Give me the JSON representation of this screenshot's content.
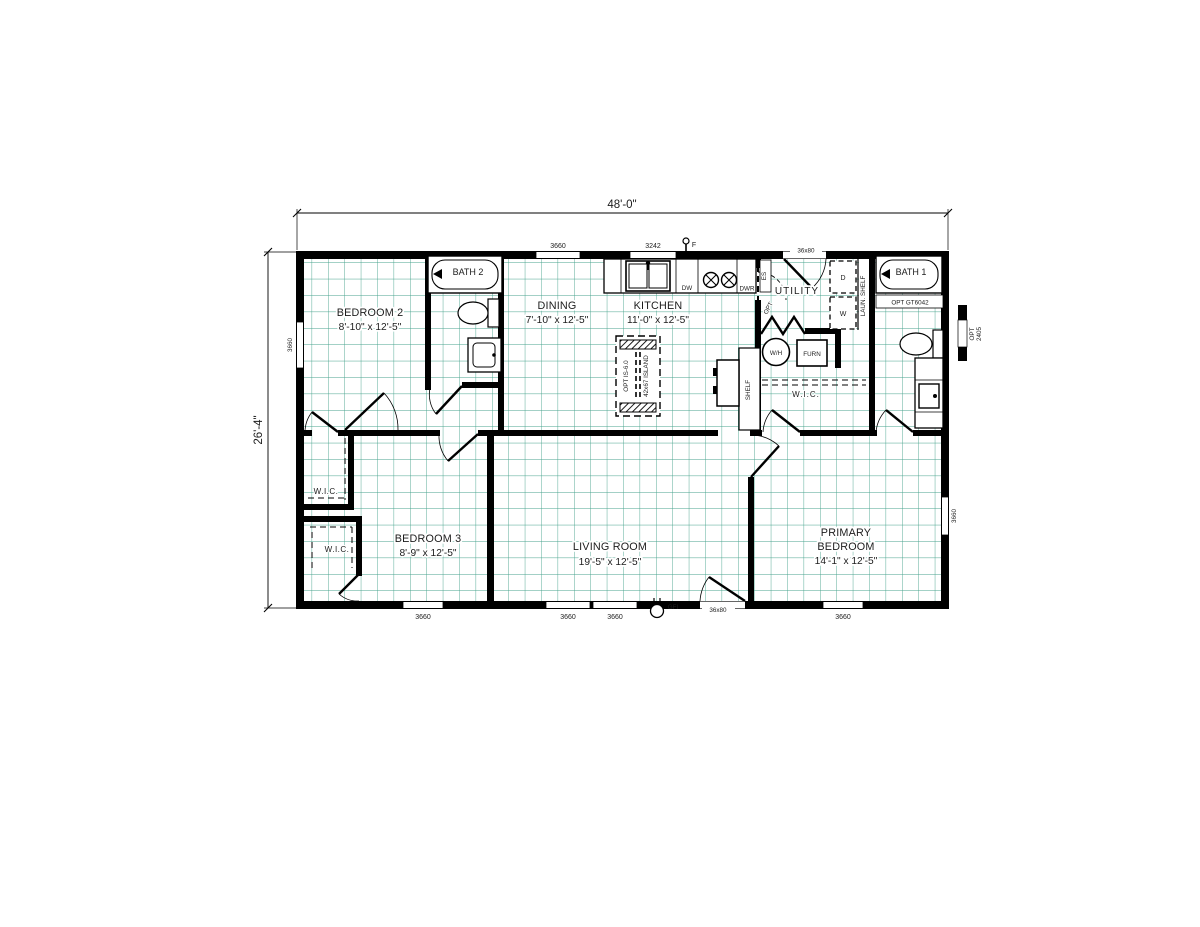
{
  "document": {
    "type": "floor-plan",
    "background": "#ffffff",
    "colors": {
      "grid": "#46a28c",
      "walls": "#000000",
      "text": "#1c1c1c"
    }
  },
  "dimensions": {
    "overall_width": "48'-0\"",
    "overall_height": "26'-4\""
  },
  "rooms": {
    "bedroom2": {
      "name": "BEDROOM 2",
      "size": "8'-10\" x 12'-5\""
    },
    "bath2": {
      "name": "BATH 2"
    },
    "dining": {
      "name": "DINING",
      "size": "7'-10\" x 12'-5\""
    },
    "kitchen": {
      "name": "KITCHEN",
      "size": "11'-0\" x 12'-5\""
    },
    "utility": {
      "name": "UTILITY"
    },
    "bath1": {
      "name": "BATH 1",
      "option": "OPT GT6042"
    },
    "wic_primary": {
      "name": "W.I.C."
    },
    "wic_bedroom2": {
      "name": "W.I.C."
    },
    "wic_bedroom3": {
      "name": "W.I.C."
    },
    "bedroom3": {
      "name": "BEDROOM 3",
      "size": "8'-9\" x 12'-5\""
    },
    "living": {
      "name": "LIVING ROOM",
      "size": "19'-5\" x 12'-5\""
    },
    "primary": {
      "name_line1": "PRIMARY",
      "name_line2": "BEDROOM",
      "size": "14'-1\" x 12'-5\""
    }
  },
  "fixtures": {
    "dishwasher": "DW",
    "drawer": "DWR",
    "water_heater": "W/H",
    "furnace": "FURN",
    "laundry_shelf": "LAUN. SHELF",
    "shelf": "SHELF",
    "dryer": "D",
    "washer": "W",
    "electrical_service": "ES",
    "fan": "F",
    "gfi": "GFI",
    "opt_door": "OPT",
    "island_line1": "OPT IS-6.0",
    "island_line2": "42x67 ISLAND",
    "opt_window_line1": "OPT",
    "opt_window_line2": "2405"
  },
  "openings": {
    "top_window_1": "3660",
    "top_window_2": "3242",
    "top_door": "36x80",
    "left_window": "3660",
    "right_window": "3660",
    "bottom_window_1": "3660",
    "bottom_window_2": "3660",
    "bottom_window_3": "3660",
    "bottom_window_4": "3660",
    "bottom_door": "36x80"
  }
}
